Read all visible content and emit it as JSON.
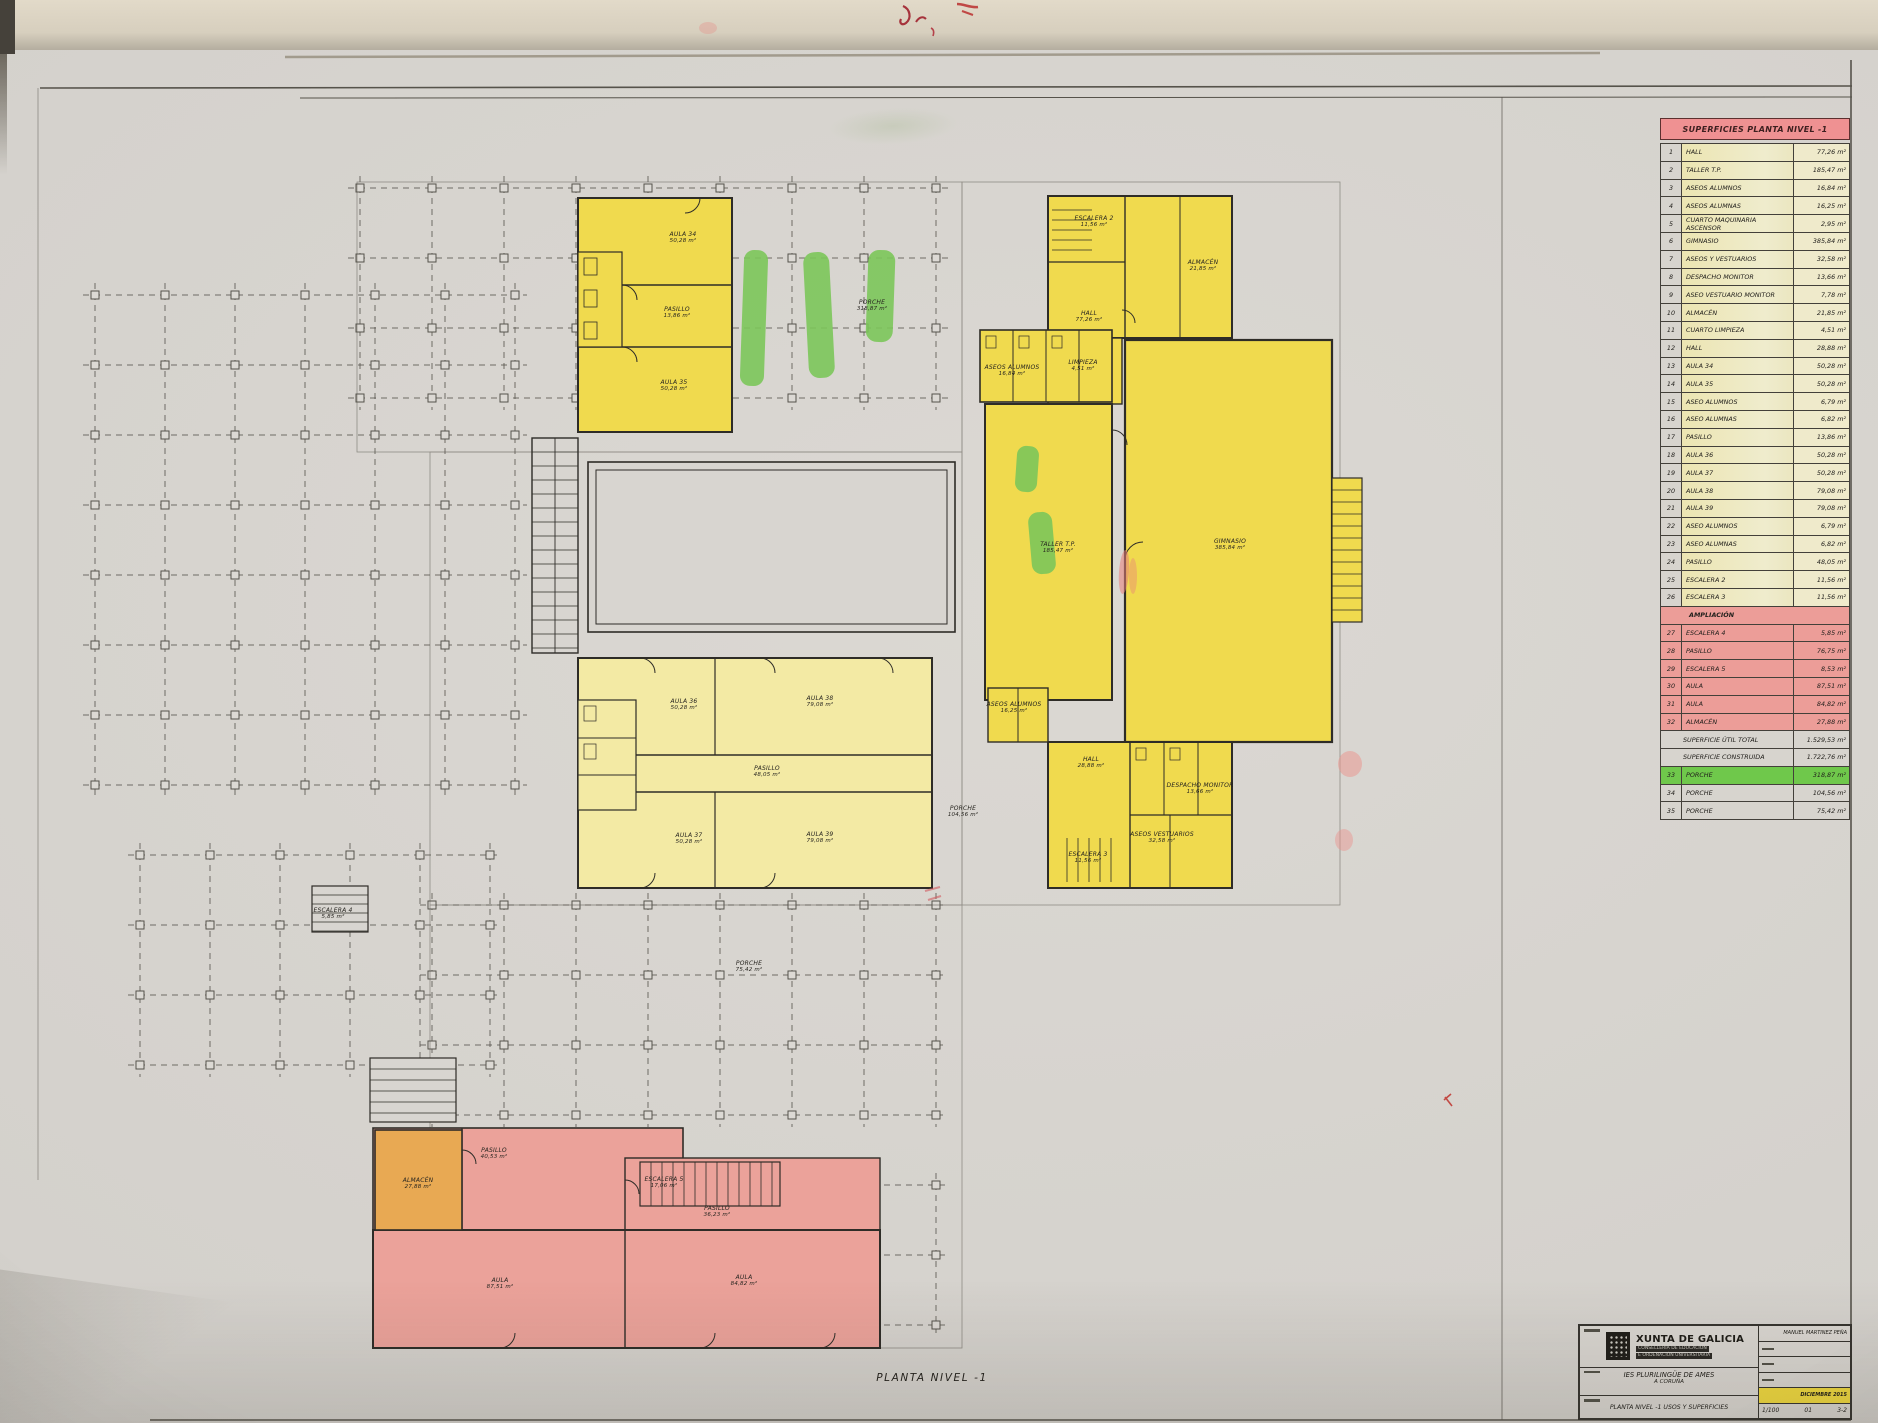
{
  "colors": {
    "highlight_yellow": "#f0da4e",
    "highlight_yellow_light": "#f3eaa4",
    "highlight_pink": "#eba29a",
    "highlight_orange": "#e8a953",
    "highlight_green": "#7cc75a",
    "legend_header_pink": "#ef9192",
    "date_highlight": "#f0d93e"
  },
  "plan": {
    "caption": "PLANTA NIVEL -1",
    "labels": [
      {
        "text": "AULA 34",
        "area": "50,28 m²",
        "x": 683,
        "y": 238
      },
      {
        "text": "PASILLO",
        "area": "13,86 m²",
        "x": 677,
        "y": 313
      },
      {
        "text": "AULA 35",
        "area": "50,28 m²",
        "x": 674,
        "y": 386
      },
      {
        "text": "PORCHE",
        "area": "318,87 m²",
        "x": 872,
        "y": 306
      },
      {
        "text": "ESCALERA 2",
        "area": "11,56 m²",
        "x": 1094,
        "y": 222
      },
      {
        "text": "HALL",
        "area": "77,26 m²",
        "x": 1089,
        "y": 317
      },
      {
        "text": "ALMACÉN",
        "area": "21,85 m²",
        "x": 1203,
        "y": 266
      },
      {
        "text": "ASEOS ALUMNOS",
        "area": "16,84 m²",
        "x": 1012,
        "y": 371
      },
      {
        "text": "LIMPIEZA",
        "area": "4,51 m²",
        "x": 1083,
        "y": 366
      },
      {
        "text": "TALLER T.P.",
        "area": "185,47 m²",
        "x": 1058,
        "y": 548
      },
      {
        "text": "GIMNASIO",
        "area": "385,84 m²",
        "x": 1230,
        "y": 545
      },
      {
        "text": "AULA 36",
        "area": "50,28 m²",
        "x": 684,
        "y": 705
      },
      {
        "text": "AULA 38",
        "area": "79,08 m²",
        "x": 820,
        "y": 702
      },
      {
        "text": "PASILLO",
        "area": "48,05 m²",
        "x": 767,
        "y": 772
      },
      {
        "text": "AULA 37",
        "area": "50,28 m²",
        "x": 689,
        "y": 839
      },
      {
        "text": "AULA 39",
        "area": "79,08 m²",
        "x": 820,
        "y": 838
      },
      {
        "text": "PORCHE",
        "area": "104,56 m²",
        "x": 963,
        "y": 812
      },
      {
        "text": "ASEOS ALUMNOS",
        "area": "16,25 m²",
        "x": 1014,
        "y": 708
      },
      {
        "text": "HALL",
        "area": "28,88 m²",
        "x": 1091,
        "y": 763
      },
      {
        "text": "ESCALERA 3",
        "area": "11,56 m²",
        "x": 1088,
        "y": 858
      },
      {
        "text": "DESPACHO MONITOR",
        "area": "13,66 m²",
        "x": 1200,
        "y": 789
      },
      {
        "text": "ASEOS VESTUARIOS",
        "area": "32,58 m²",
        "x": 1162,
        "y": 838
      },
      {
        "text": "ESCALERA 4",
        "area": "5,85 m²",
        "x": 333,
        "y": 914
      },
      {
        "text": "ALMACÉN",
        "area": "27,88 m²",
        "x": 418,
        "y": 1184
      },
      {
        "text": "PASILLO",
        "area": "40,53 m²",
        "x": 494,
        "y": 1154
      },
      {
        "text": "ESCALERA 5",
        "area": "17,06 m²",
        "x": 664,
        "y": 1183
      },
      {
        "text": "PASILLO",
        "area": "36,23 m²",
        "x": 717,
        "y": 1212
      },
      {
        "text": "AULA",
        "area": "87,51 m²",
        "x": 500,
        "y": 1284
      },
      {
        "text": "AULA",
        "area": "84,82 m²",
        "x": 744,
        "y": 1281
      },
      {
        "text": "PORCHE",
        "area": "75,42 m²",
        "x": 749,
        "y": 967
      }
    ]
  },
  "legend": {
    "title": "SUPERFICIES PLANTA NIVEL -1",
    "rows": [
      {
        "n": "1",
        "label": "HALL",
        "value": "77,26 m²",
        "tint": "yellow"
      },
      {
        "n": "2",
        "label": "TALLER T.P.",
        "value": "185,47 m²",
        "tint": "yellow"
      },
      {
        "n": "3",
        "label": "ASEOS ALUMNOS",
        "value": "16,84 m²",
        "tint": "yellow"
      },
      {
        "n": "4",
        "label": "ASEOS ALUMNAS",
        "value": "16,25 m²",
        "tint": "yellow"
      },
      {
        "n": "5",
        "label": "CUARTO MAQUINARIA ASCENSOR",
        "value": "2,95 m²",
        "tint": "yellow"
      },
      {
        "n": "6",
        "label": "GIMNASIO",
        "value": "385,84 m²",
        "tint": "yellow"
      },
      {
        "n": "7",
        "label": "ASEOS Y VESTUARIOS",
        "value": "32,58 m²",
        "tint": "yellow"
      },
      {
        "n": "8",
        "label": "DESPACHO MONITOR",
        "value": "13,66 m²",
        "tint": "yellow"
      },
      {
        "n": "9",
        "label": "ASEO VESTUARIO MONITOR",
        "value": "7,78 m²",
        "tint": "yellow"
      },
      {
        "n": "10",
        "label": "ALMACÉN",
        "value": "21,85 m²",
        "tint": "yellow"
      },
      {
        "n": "11",
        "label": "CUARTO LIMPIEZA",
        "value": "4,51 m²",
        "tint": "yellow"
      },
      {
        "n": "12",
        "label": "HALL",
        "value": "28,88 m²",
        "tint": "yellow"
      },
      {
        "n": "13",
        "label": "AULA 34",
        "value": "50,28 m²",
        "tint": "yellow"
      },
      {
        "n": "14",
        "label": "AULA 35",
        "value": "50,28 m²",
        "tint": "yellow"
      },
      {
        "n": "15",
        "label": "ASEO ALUMNOS",
        "value": "6,79 m²",
        "tint": "yellow"
      },
      {
        "n": "16",
        "label": "ASEO ALUMNAS",
        "value": "6,82 m²",
        "tint": "yellow"
      },
      {
        "n": "17",
        "label": "PASILLO",
        "value": "13,86 m²",
        "tint": "yellow"
      },
      {
        "n": "18",
        "label": "AULA 36",
        "value": "50,28 m²",
        "tint": "yellow"
      },
      {
        "n": "19",
        "label": "AULA 37",
        "value": "50,28 m²",
        "tint": "yellow"
      },
      {
        "n": "20",
        "label": "AULA 38",
        "value": "79,08 m²",
        "tint": "yellow"
      },
      {
        "n": "21",
        "label": "AULA 39",
        "value": "79,08 m²",
        "tint": "yellow"
      },
      {
        "n": "22",
        "label": "ASEO ALUMNOS",
        "value": "6,79 m²",
        "tint": "yellow"
      },
      {
        "n": "23",
        "label": "ASEO ALUMNAS",
        "value": "6,82 m²",
        "tint": "yellow"
      },
      {
        "n": "24",
        "label": "PASILLO",
        "value": "48,05 m²",
        "tint": "yellow"
      },
      {
        "n": "25",
        "label": "ESCALERA 2",
        "value": "11,56 m²",
        "tint": "yellow"
      },
      {
        "n": "26",
        "label": "ESCALERA 3",
        "value": "11,56 m²",
        "tint": "yellow"
      },
      {
        "type": "section",
        "label": "AMPLIACIÓN"
      },
      {
        "n": "27",
        "label": "ESCALERA 4",
        "value": "5,85 m²",
        "tint": "pink"
      },
      {
        "n": "28",
        "label": "PASILLO",
        "value": "76,75 m²",
        "tint": "pink"
      },
      {
        "n": "29",
        "label": "ESCALERA 5",
        "value": "8,53 m²",
        "tint": "pink"
      },
      {
        "n": "30",
        "label": "AULA",
        "value": "87,51 m²",
        "tint": "pink"
      },
      {
        "n": "31",
        "label": "AULA",
        "value": "84,82 m²",
        "tint": "pink"
      },
      {
        "n": "32",
        "label": "ALMACÉN",
        "value": "27,88 m²",
        "tint": "pink"
      },
      {
        "type": "total",
        "label": "SUPERFICIE ÚTIL TOTAL",
        "value": "1.529,53 m²"
      },
      {
        "type": "total",
        "label": "SUPERFICIE CONSTRUIDA",
        "value": "1.722,76 m²"
      },
      {
        "n": "33",
        "label": "PORCHE",
        "value": "318,87 m²",
        "tint": "green"
      },
      {
        "n": "34",
        "label": "PORCHE",
        "value": "104,56 m²"
      },
      {
        "n": "35",
        "label": "PORCHE",
        "value": "75,42 m²"
      }
    ]
  },
  "title_block": {
    "org": "XUNTA DE GALICIA",
    "org_line1": "CONSELLERÍA DE EDUCACIÓN",
    "org_line2": "E ORDENACIÓN UNIVERSITARIA",
    "project_line1": "IES PLURILINGÜE DE AMES",
    "project_line2": "A CORUÑA",
    "sheet_title": "PLANTA NIVEL -1 USOS Y SUPERFICIES",
    "author": "MANUEL MARTINEZ PEÑA",
    "date": "DICIEMBRE 2015",
    "scale": "1/100",
    "sheet_num": "01",
    "sheet_ref": "3-2"
  }
}
